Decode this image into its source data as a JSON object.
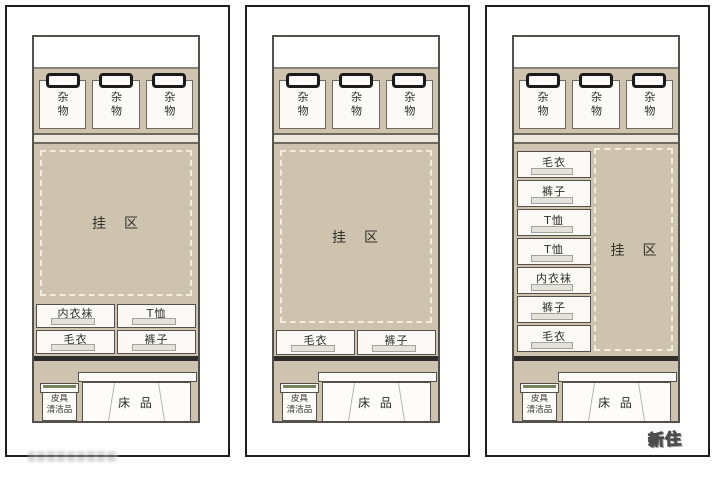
{
  "colors": {
    "zone_beige": "#cdc3ae",
    "dashed_line": "#f3eddb",
    "care_lid_green": "#73875f",
    "panel_border": "#1f1f1f"
  },
  "logo": "新住",
  "panels": [
    {
      "name": "wardrobe-layout-1",
      "boxes": [
        "杂物",
        "杂物",
        "杂物"
      ],
      "hang_label": "挂　区",
      "drawers": [
        "内衣袜",
        "T恤",
        "毛衣",
        "裤子"
      ],
      "bottom": {
        "care_line1": "皮具",
        "care_line2": "清洁品",
        "bedding": "床 品"
      }
    },
    {
      "name": "wardrobe-layout-2",
      "boxes": [
        "杂物",
        "杂物",
        "杂物"
      ],
      "hang_label": "挂　区",
      "drawers": [
        "毛衣",
        "裤子"
      ],
      "bottom": {
        "care_line1": "皮具",
        "care_line2": "清洁品",
        "bedding": "床 品"
      }
    },
    {
      "name": "wardrobe-layout-3",
      "boxes": [
        "杂物",
        "杂物",
        "杂物"
      ],
      "hang_label": "挂　区",
      "drawers": [
        "毛衣",
        "裤子",
        "T恤",
        "T恤",
        "内衣袜",
        "裤子",
        "毛衣"
      ],
      "bottom": {
        "care_line1": "皮具",
        "care_line2": "清洁品",
        "bedding": "床 品"
      }
    }
  ]
}
